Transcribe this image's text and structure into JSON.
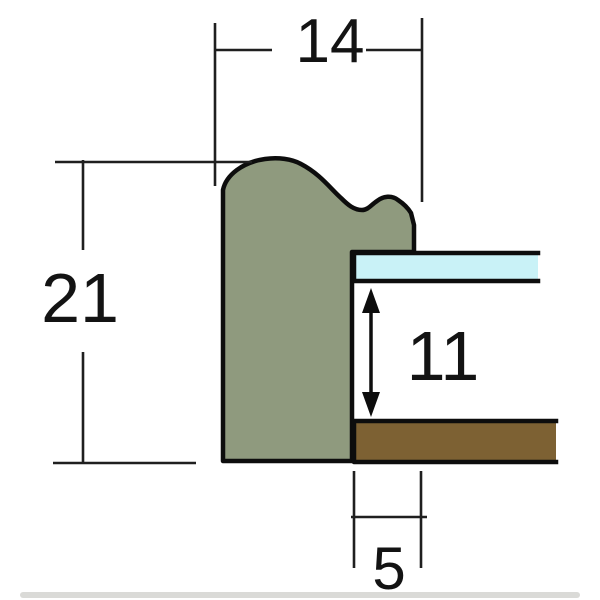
{
  "diagram": {
    "dimensions": {
      "overall_width": "14",
      "overall_height": "21",
      "rabbet_depth": "11",
      "lip_width": "5"
    },
    "colors": {
      "moulding": "#8f9a7e",
      "glass": "#c9f2f7",
      "backing": "#7d6133",
      "outline": "#0d0d0d",
      "dimension_line": "#1f1f1f",
      "label_text": "#131313",
      "baseline_bar": "#dadad7",
      "background": "#ffffff"
    }
  }
}
